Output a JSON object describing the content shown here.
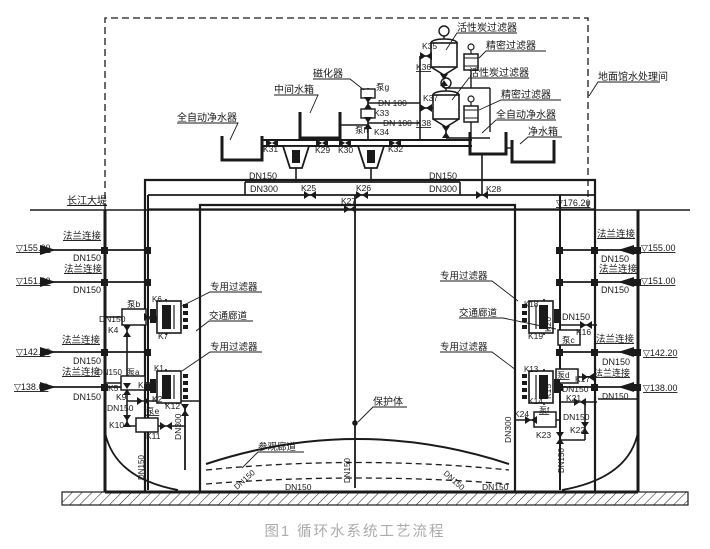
{
  "caption": "图1 循环水系统工艺流程",
  "colors": {
    "line": "#1a1a1a",
    "caption": "#ababab",
    "background": "#ffffff"
  },
  "annotations": [
    {
      "n": "label-activated-carbon-filter-1",
      "t": "活性炭过滤器",
      "x": 457,
      "y": 31,
      "fs": 10
    },
    {
      "n": "label-precision-filter-1",
      "t": "精密过滤器",
      "x": 486,
      "y": 49,
      "fs": 10
    },
    {
      "n": "label-activated-carbon-filter-2",
      "t": "活性炭过滤器",
      "x": 469,
      "y": 76,
      "fs": 10
    },
    {
      "n": "label-precision-filter-2",
      "t": "精密过滤器",
      "x": 501,
      "y": 98,
      "fs": 10
    },
    {
      "n": "label-auto-purifier-right",
      "t": "全自动净水器",
      "x": 496,
      "y": 118,
      "fs": 10
    },
    {
      "n": "label-clean-water-tank",
      "t": "净水箱",
      "x": 528,
      "y": 135,
      "fs": 10
    },
    {
      "n": "label-magnetizer",
      "t": "磁化器",
      "x": 313,
      "y": 77,
      "fs": 10
    },
    {
      "n": "label-intermediate-tank",
      "t": "中间水箱",
      "x": 274,
      "y": 93,
      "fs": 10
    },
    {
      "n": "label-auto-purifier-left",
      "t": "全自动净水器",
      "x": 177,
      "y": 121,
      "fs": 10
    },
    {
      "n": "label-pump-g",
      "t": "泵g",
      "x": 376,
      "y": 90,
      "fs": 8.5
    },
    {
      "n": "label-dn100-1",
      "t": "DN 100",
      "x": 378,
      "y": 106,
      "fs": 8.5
    },
    {
      "n": "label-k33",
      "t": "K33",
      "x": 374,
      "y": 116,
      "fs": 8.5
    },
    {
      "n": "label-dn100-2",
      "t": "DN 100",
      "x": 383,
      "y": 126,
      "fs": 8.5
    },
    {
      "n": "label-pump-h",
      "t": "泵h",
      "x": 355,
      "y": 133,
      "fs": 8.5
    },
    {
      "n": "label-k34",
      "t": "K34",
      "x": 374,
      "y": 135,
      "fs": 8.5
    },
    {
      "n": "label-k35",
      "t": "K35",
      "x": 422,
      "y": 49,
      "fs": 8.5
    },
    {
      "n": "label-k36",
      "t": "K36",
      "x": 416,
      "y": 70,
      "u": 1,
      "fs": 8.5
    },
    {
      "n": "label-k37",
      "t": "K37",
      "x": 423,
      "y": 101,
      "fs": 8.5
    },
    {
      "n": "label-k38",
      "t": "K38",
      "x": 416,
      "y": 126,
      "u": 1,
      "fs": 8.5
    },
    {
      "n": "label-treatment-room",
      "t": "地面馆水处理间",
      "x": 598,
      "y": 80,
      "fs": 10
    },
    {
      "n": "label-k31",
      "t": "K31",
      "x": 263,
      "y": 152,
      "fs": 8.5
    },
    {
      "n": "label-k29",
      "t": "K29",
      "x": 315,
      "y": 153,
      "fs": 8.5
    },
    {
      "n": "label-k30",
      "t": "K30",
      "x": 338,
      "y": 153,
      "fs": 8.5
    },
    {
      "n": "label-k32",
      "t": "K32",
      "x": 388,
      "y": 152,
      "fs": 8.5
    },
    {
      "n": "label-dn150-top-left",
      "t": "DN150",
      "x": 249,
      "y": 179,
      "fs": 9
    },
    {
      "n": "label-dn300-top-left",
      "t": "DN300",
      "x": 250,
      "y": 192,
      "fs": 9
    },
    {
      "n": "label-k25",
      "t": "K25",
      "x": 301,
      "y": 191,
      "fs": 8.5
    },
    {
      "n": "label-k26",
      "t": "K26",
      "x": 356,
      "y": 191,
      "fs": 8.5
    },
    {
      "n": "label-dn150-top-right",
      "t": "DN150",
      "x": 429,
      "y": 179,
      "fs": 9
    },
    {
      "n": "label-dn300-top-right",
      "t": "DN300",
      "x": 429,
      "y": 192,
      "fs": 9
    },
    {
      "n": "label-k27",
      "t": "K27",
      "x": 341,
      "y": 204,
      "fs": 8.5
    },
    {
      "n": "label-k28",
      "t": "K28",
      "x": 486,
      "y": 192,
      "fs": 8.5
    },
    {
      "n": "label-elev-176-20",
      "t": "▽176.20",
      "x": 556,
      "y": 206,
      "u": 1,
      "fs": 9
    },
    {
      "n": "label-yangtze-dike",
      "t": "长江大堤",
      "x": 67,
      "y": 204,
      "u": 1,
      "fs": 10
    },
    {
      "n": "label-flange-left-1",
      "t": "法兰连接",
      "x": 63,
      "y": 239,
      "u": 1,
      "fs": 9.5
    },
    {
      "n": "label-elev-155-left",
      "t": "▽155.00",
      "x": 16,
      "y": 251,
      "u": 1,
      "fs": 9
    },
    {
      "n": "label-dn150-left-1",
      "t": "DN150",
      "x": 73,
      "y": 261,
      "fs": 9
    },
    {
      "n": "label-flange-left-2",
      "t": "法兰连接",
      "x": 64,
      "y": 272,
      "u": 1,
      "fs": 9.5
    },
    {
      "n": "label-elev-151-left",
      "t": "▽151.00",
      "x": 16,
      "y": 284,
      "u": 1,
      "fs": 9
    },
    {
      "n": "label-dn150-left-2",
      "t": "DN150",
      "x": 73,
      "y": 293,
      "fs": 9
    },
    {
      "n": "label-pump-b",
      "t": "泵b",
      "x": 127,
      "y": 307,
      "fs": 8.5
    },
    {
      "n": "label-dn150-left-3",
      "t": "DN150",
      "x": 99,
      "y": 322,
      "fs": 8.5
    },
    {
      "n": "label-k8",
      "t": "K8",
      "x": 147,
      "y": 322,
      "fs": 8.5
    },
    {
      "n": "label-k4",
      "t": "K4",
      "x": 108,
      "y": 333,
      "fs": 8.5
    },
    {
      "n": "label-flange-left-3",
      "t": "法兰连接",
      "x": 62,
      "y": 343,
      "u": 1,
      "fs": 9.5
    },
    {
      "n": "label-elev-142-left",
      "t": "▽142.20",
      "x": 16,
      "y": 355,
      "u": 1,
      "fs": 9
    },
    {
      "n": "label-dn150-left-4",
      "t": "DN150",
      "x": 73,
      "y": 364,
      "fs": 9
    },
    {
      "n": "label-flange-left-4",
      "t": "法兰连接",
      "x": 62,
      "y": 375,
      "u": 1,
      "fs": 9.5
    },
    {
      "n": "label-dn150-left-5",
      "t": "DN150",
      "x": 97,
      "y": 375,
      "fs": 8
    },
    {
      "n": "label-pump-a",
      "t": "泵a",
      "x": 127,
      "y": 375,
      "fs": 8
    },
    {
      "n": "label-elev-138-left",
      "t": "▽138.00",
      "x": 14,
      "y": 390,
      "u": 1,
      "fs": 9
    },
    {
      "n": "label-k5",
      "t": "K5",
      "x": 108,
      "y": 391,
      "fs": 8.5
    },
    {
      "n": "label-k9",
      "t": "K9",
      "x": 116,
      "y": 400,
      "fs": 8.5
    },
    {
      "n": "label-dn150-left-6",
      "t": "DN150",
      "x": 73,
      "y": 400,
      "fs": 9
    },
    {
      "n": "label-dn150-left-7",
      "t": "DN150",
      "x": 107,
      "y": 411,
      "fs": 8.5
    },
    {
      "n": "label-k10",
      "t": "K10",
      "x": 109,
      "y": 428,
      "fs": 8.5
    },
    {
      "n": "label-pump-e",
      "t": "泵e",
      "x": 146,
      "y": 414,
      "u": 1,
      "fs": 8.5
    },
    {
      "n": "label-k11",
      "t": "K11",
      "x": 146,
      "y": 439,
      "fs": 8.5
    },
    {
      "n": "label-dn300-left-vert",
      "t": "DN300",
      "x": 181,
      "y": 440,
      "r": -90,
      "fs": 8.5
    },
    {
      "n": "label-k1",
      "t": "K1",
      "x": 154,
      "y": 371,
      "fs": 8
    },
    {
      "n": "label-k3",
      "t": "K3",
      "x": 138,
      "y": 388,
      "fs": 8.5
    },
    {
      "n": "label-k2",
      "t": "K2",
      "x": 152,
      "y": 402,
      "fs": 8.5
    },
    {
      "n": "label-k12",
      "t": "K12",
      "x": 165,
      "y": 409,
      "fs": 8.5
    },
    {
      "n": "label-dedicated-filter-left-1",
      "t": "专用过滤器",
      "x": 210,
      "y": 290,
      "fs": 9.5
    },
    {
      "n": "label-traffic-corridor-left",
      "t": "交通廊道",
      "x": 209,
      "y": 319,
      "fs": 9.5
    },
    {
      "n": "label-dedicated-filter-left-2",
      "t": "专用过滤器",
      "x": 210,
      "y": 350,
      "fs": 9.5
    },
    {
      "n": "label-k6",
      "t": "K6",
      "x": 152,
      "y": 302,
      "fs": 8
    },
    {
      "n": "label-k7",
      "t": "K7",
      "x": 158,
      "y": 339,
      "fs": 8.5
    },
    {
      "n": "label-dedicated-filter-right-1",
      "t": "专用过滤器",
      "x": 440,
      "y": 279,
      "fs": 9.5
    },
    {
      "n": "label-traffic-corridor-right",
      "t": "交通廊道",
      "x": 459,
      "y": 316,
      "fs": 9.5
    },
    {
      "n": "label-dedicated-filter-right-2",
      "t": "专用过滤器",
      "x": 440,
      "y": 350,
      "fs": 9.5
    },
    {
      "n": "label-k18",
      "t": "K18",
      "x": 524,
      "y": 307,
      "fs": 8
    },
    {
      "n": "label-k20",
      "t": "K20",
      "x": 551,
      "y": 332,
      "r": -90,
      "fs": 8.5
    },
    {
      "n": "label-k19",
      "t": "K19",
      "x": 528,
      "y": 339,
      "fs": 8.5
    },
    {
      "n": "label-k13",
      "t": "K13",
      "x": 524,
      "y": 372,
      "fs": 8
    },
    {
      "n": "label-k15",
      "t": "K15",
      "x": 551,
      "y": 399,
      "r": -90,
      "fs": 8.5
    },
    {
      "n": "label-k14",
      "t": "K14",
      "x": 528,
      "y": 404,
      "fs": 8.5
    },
    {
      "n": "label-flange-right-1",
      "t": "法兰连接",
      "x": 597,
      "y": 237,
      "u": 1,
      "fs": 9.5
    },
    {
      "n": "label-elev-155-right",
      "t": "▽155.00",
      "x": 641,
      "y": 251,
      "u": 1,
      "fs": 9
    },
    {
      "n": "label-dn150-right-1",
      "t": "DN150",
      "x": 601,
      "y": 262,
      "fs": 9
    },
    {
      "n": "label-flange-right-2",
      "t": "法兰连接",
      "x": 599,
      "y": 272,
      "u": 1,
      "fs": 9.5
    },
    {
      "n": "label-elev-151-right",
      "t": "▽151.00",
      "x": 641,
      "y": 284,
      "u": 1,
      "fs": 9
    },
    {
      "n": "label-dn150-right-2",
      "t": "DN150",
      "x": 601,
      "y": 293,
      "fs": 9
    },
    {
      "n": "label-dn150-right-3",
      "t": "DN150",
      "x": 562,
      "y": 320,
      "fs": 9
    },
    {
      "n": "label-k16",
      "t": "K16",
      "x": 576,
      "y": 335,
      "fs": 8.5
    },
    {
      "n": "label-pump-c",
      "t": "泵c",
      "x": 562,
      "y": 343,
      "fs": 8.5
    },
    {
      "n": "label-flange-right-3",
      "t": "法兰连接",
      "x": 596,
      "y": 342,
      "u": 1,
      "fs": 9.5
    },
    {
      "n": "label-elev-142-right",
      "t": "▽142.20",
      "x": 643,
      "y": 356,
      "u": 1,
      "fs": 9
    },
    {
      "n": "label-dn150-right-4",
      "t": "DN150",
      "x": 602,
      "y": 365,
      "fs": 9
    },
    {
      "n": "label-pump-d",
      "t": "泵d",
      "x": 557,
      "y": 378,
      "u": 1,
      "fs": 8
    },
    {
      "n": "label-k17",
      "t": "K17",
      "x": 575,
      "y": 382,
      "fs": 8.5
    },
    {
      "n": "label-flange-right-4",
      "t": "法兰连接",
      "x": 594,
      "y": 376,
      "u": 1,
      "fs": 9
    },
    {
      "n": "label-elev-138-right",
      "t": "▽138.00",
      "x": 643,
      "y": 391,
      "u": 1,
      "fs": 9
    },
    {
      "n": "label-dn150-right-5",
      "t": "DN150",
      "x": 562,
      "y": 392,
      "fs": 8.5
    },
    {
      "n": "label-k21",
      "t": "K21",
      "x": 566,
      "y": 401,
      "fs": 8.5
    },
    {
      "n": "label-dn150-right-6",
      "t": "DN150",
      "x": 602,
      "y": 399,
      "fs": 8.5
    },
    {
      "n": "label-k24",
      "t": "K24",
      "x": 514,
      "y": 417,
      "fs": 8.5
    },
    {
      "n": "label-pump-f",
      "t": "泵f",
      "x": 539,
      "y": 413,
      "u": 1,
      "fs": 8
    },
    {
      "n": "label-dn150-right-7",
      "t": "DN150",
      "x": 563,
      "y": 420,
      "fs": 8.5
    },
    {
      "n": "label-k22",
      "t": "K22",
      "x": 570,
      "y": 433,
      "fs": 8.5
    },
    {
      "n": "label-k23",
      "t": "K23",
      "x": 536,
      "y": 438,
      "fs": 8.5
    },
    {
      "n": "label-dn300-right-vert",
      "t": "DN300",
      "x": 511,
      "y": 443,
      "r": -90,
      "fs": 8.5
    },
    {
      "n": "label-dn150-right-vert",
      "t": "DN150",
      "x": 564,
      "y": 473,
      "r": -90,
      "fs": 8
    },
    {
      "n": "label-protection-body",
      "t": "保护体",
      "x": 373,
      "y": 405,
      "fs": 10
    },
    {
      "n": "label-visiting-corridor",
      "t": "参观廊道",
      "x": 258,
      "y": 450,
      "fs": 9.5
    },
    {
      "n": "label-dn150-center-vert",
      "t": "DN150",
      "x": 350,
      "y": 483,
      "r": -90,
      "fs": 8
    },
    {
      "n": "label-dn150-diag-left",
      "t": "DN150",
      "x": 237,
      "y": 490,
      "r": -42,
      "fs": 8
    },
    {
      "n": "label-dn150-bottom-1",
      "t": "DN150",
      "x": 285,
      "y": 490,
      "fs": 8.5
    },
    {
      "n": "label-dn150-diag-right",
      "t": "DN150",
      "x": 443,
      "y": 474,
      "r": 42,
      "fs": 8
    },
    {
      "n": "label-dn150-bottom-2",
      "t": "DN150",
      "x": 482,
      "y": 490,
      "fs": 8.5
    },
    {
      "n": "label-dn150-left-vert",
      "t": "DN150",
      "x": 144,
      "y": 480,
      "r": -90,
      "fs": 8
    }
  ],
  "valves": [
    {
      "id": "K25",
      "x": 310,
      "y": 195,
      "o": "h"
    },
    {
      "id": "K26",
      "x": 362,
      "y": 195,
      "o": "h"
    },
    {
      "id": "K27",
      "x": 350,
      "y": 209,
      "o": "h"
    },
    {
      "id": "K28",
      "x": 482,
      "y": 195,
      "o": "h"
    },
    {
      "id": "K29",
      "x": 322,
      "y": 143,
      "o": "h"
    },
    {
      "id": "K30",
      "x": 345,
      "y": 143,
      "o": "h"
    },
    {
      "id": "K31",
      "x": 272,
      "y": 143,
      "o": "h"
    },
    {
      "id": "K32",
      "x": 395,
      "y": 143,
      "o": "h"
    },
    {
      "id": "K33",
      "x": 368,
      "y": 103,
      "o": "v"
    },
    {
      "id": "K34",
      "x": 368,
      "y": 123,
      "o": "v"
    },
    {
      "id": "K35",
      "x": 426,
      "y": 56,
      "o": "h"
    },
    {
      "id": "K36",
      "x": 444,
      "y": 80,
      "o": "v"
    },
    {
      "id": "K37",
      "x": 426,
      "y": 108,
      "o": "h"
    },
    {
      "id": "K38",
      "x": 446,
      "y": 132,
      "o": "v"
    },
    {
      "id": "K4",
      "x": 127,
      "y": 331,
      "o": "v"
    },
    {
      "id": "K5",
      "x": 127,
      "y": 389,
      "o": "v"
    },
    {
      "id": "K8",
      "x": 150,
      "y": 317,
      "o": "h"
    },
    {
      "id": "K9",
      "x": 143,
      "y": 401,
      "o": "h"
    },
    {
      "id": "K10",
      "x": 127,
      "y": 421,
      "o": "v"
    },
    {
      "id": "K11",
      "x": 166,
      "y": 426,
      "o": "h"
    },
    {
      "id": "K12",
      "x": 185,
      "y": 410,
      "o": "v"
    },
    {
      "id": "K16",
      "x": 586,
      "y": 325,
      "o": "h"
    },
    {
      "id": "K17",
      "x": 588,
      "y": 377,
      "o": "h"
    },
    {
      "id": "K21",
      "x": 580,
      "y": 402,
      "o": "h"
    },
    {
      "id": "K22",
      "x": 585,
      "y": 428,
      "o": "v"
    },
    {
      "id": "K23",
      "x": 560,
      "y": 438,
      "o": "v"
    },
    {
      "id": "K24",
      "x": 531,
      "y": 420,
      "o": "h"
    }
  ]
}
